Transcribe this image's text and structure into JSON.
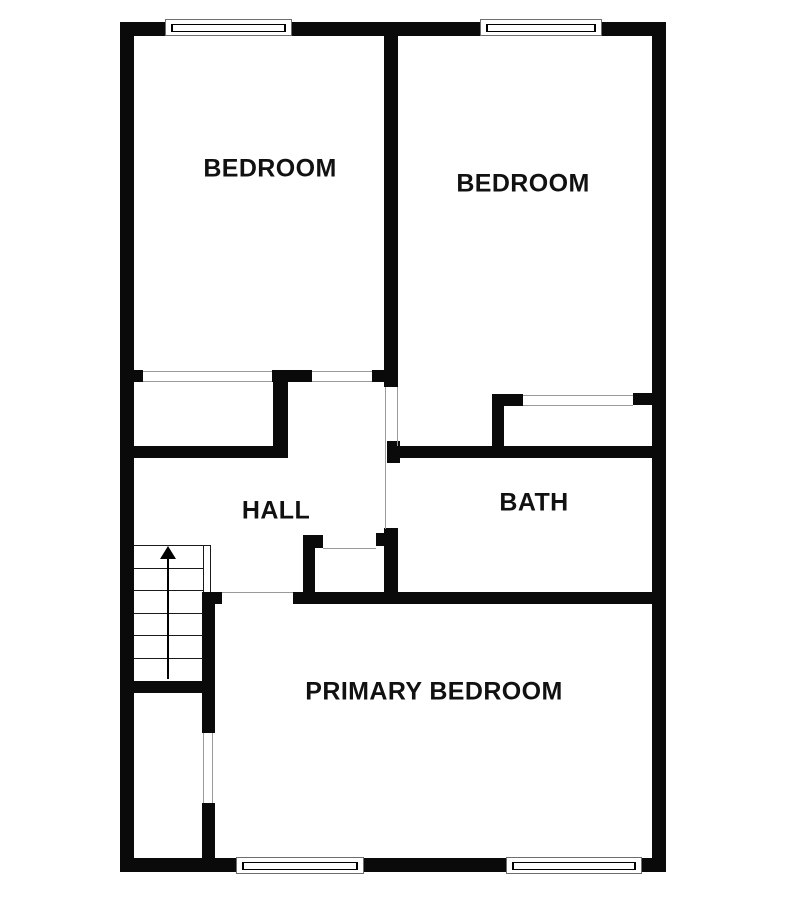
{
  "colors": {
    "wall": "#0a0a0a",
    "opening_line": "#9a9a9a",
    "stair_line": "#1a1a1a",
    "text": "#111111",
    "background": "#ffffff"
  },
  "rooms": [
    {
      "id": "bedroom-left",
      "label": "BEDROOM",
      "center": [
        270,
        169
      ]
    },
    {
      "id": "bedroom-right",
      "label": "BEDROOM",
      "center": [
        523,
        184
      ]
    },
    {
      "id": "hall",
      "label": "HALL",
      "center": [
        276,
        511
      ]
    },
    {
      "id": "bath",
      "label": "BATH",
      "center": [
        534,
        503
      ]
    },
    {
      "id": "primary-bedroom",
      "label": "PRIMARY BEDROOM",
      "center": [
        434,
        692
      ]
    }
  ],
  "walls": [
    {
      "name": "exterior-top",
      "x": 120,
      "y": 22,
      "w": 546,
      "h": 14
    },
    {
      "name": "exterior-left",
      "x": 120,
      "y": 22,
      "w": 14,
      "h": 850
    },
    {
      "name": "exterior-right",
      "x": 652,
      "y": 22,
      "w": 14,
      "h": 850
    },
    {
      "name": "exterior-bottom",
      "x": 120,
      "y": 858,
      "w": 546,
      "h": 14
    },
    {
      "name": "bedroom-divider",
      "x": 384,
      "y": 36,
      "w": 14,
      "h": 351
    },
    {
      "name": "bedroom1-south-stub-left",
      "x": 134,
      "y": 370,
      "w": 9,
      "h": 12
    },
    {
      "name": "bedroom1-south-mid",
      "x": 272,
      "y": 370,
      "w": 40,
      "h": 12
    },
    {
      "name": "bedroom1-south-stub-right",
      "x": 372,
      "y": 370,
      "w": 12,
      "h": 12
    },
    {
      "name": "bedroom1-closet-east",
      "x": 273,
      "y": 382,
      "w": 15,
      "h": 76
    },
    {
      "name": "hall-north",
      "x": 120,
      "y": 446,
      "w": 168,
      "h": 12
    },
    {
      "name": "bedroom2-south-left",
      "x": 492,
      "y": 394,
      "w": 31,
      "h": 12
    },
    {
      "name": "bedroom2-closet-west",
      "x": 492,
      "y": 394,
      "w": 12,
      "h": 64
    },
    {
      "name": "bedroom2-south-stub-right",
      "x": 633,
      "y": 393,
      "w": 19,
      "h": 12
    },
    {
      "name": "bath-north-stub",
      "x": 387,
      "y": 441,
      "w": 13,
      "h": 22
    },
    {
      "name": "bath-north",
      "x": 387,
      "y": 446,
      "w": 265,
      "h": 12
    },
    {
      "name": "hall-south",
      "x": 293,
      "y": 592,
      "w": 359,
      "h": 12
    },
    {
      "name": "hall-south-corner",
      "x": 202,
      "y": 592,
      "w": 20,
      "h": 12
    },
    {
      "name": "closet-east-upper",
      "x": 202,
      "y": 592,
      "w": 13,
      "h": 141
    },
    {
      "name": "closet-east-lower",
      "x": 202,
      "y": 803,
      "w": 13,
      "h": 55
    },
    {
      "name": "stairwell-south",
      "x": 134,
      "y": 681,
      "w": 81,
      "h": 12
    },
    {
      "name": "hall-closet-west",
      "x": 303,
      "y": 535,
      "w": 12,
      "h": 57
    },
    {
      "name": "hall-closet-west-jamb",
      "x": 315,
      "y": 535,
      "w": 8,
      "h": 13
    },
    {
      "name": "hall-closet-east",
      "x": 384,
      "y": 528,
      "w": 14,
      "h": 64
    },
    {
      "name": "hall-closet-east-jamb",
      "x": 376,
      "y": 533,
      "w": 8,
      "h": 13
    }
  ],
  "opening_lines": [
    {
      "name": "bedroom1-closet-opening-top",
      "x": 143,
      "y": 371,
      "w": 129,
      "h": 1.3
    },
    {
      "name": "bedroom1-closet-opening-bottom",
      "x": 143,
      "y": 380.7,
      "w": 129,
      "h": 1.3
    },
    {
      "name": "bedroom1-door-opening-top",
      "x": 312,
      "y": 371,
      "w": 60,
      "h": 1.3
    },
    {
      "name": "bedroom1-door-opening-bottom",
      "x": 312,
      "y": 380.7,
      "w": 60,
      "h": 1.3
    },
    {
      "name": "vestibule-opening-west",
      "x": 385,
      "y": 387,
      "w": 1.3,
      "h": 142
    },
    {
      "name": "vestibule-opening-east",
      "x": 396.7,
      "y": 387,
      "w": 1.3,
      "h": 59
    },
    {
      "name": "bedroom2-closet-opening-top",
      "x": 523,
      "y": 394.5,
      "w": 110,
      "h": 1.3
    },
    {
      "name": "bedroom2-closet-opening-bottom",
      "x": 523,
      "y": 404.7,
      "w": 110,
      "h": 1.3
    },
    {
      "name": "hall-closet-opening",
      "x": 323,
      "y": 548,
      "w": 53,
      "h": 1.3
    },
    {
      "name": "primary-bedroom-door-opening",
      "x": 222,
      "y": 592,
      "w": 71,
      "h": 1.3
    },
    {
      "name": "closet-door-opening-west",
      "x": 202.7,
      "y": 733,
      "w": 1.3,
      "h": 70
    },
    {
      "name": "closet-door-opening-east",
      "x": 212,
      "y": 733,
      "w": 1.3,
      "h": 70
    }
  ],
  "windows": [
    {
      "name": "window-top-left",
      "x": 165,
      "y": 19,
      "w": 127,
      "h": 17
    },
    {
      "name": "window-top-right",
      "x": 480,
      "y": 19,
      "w": 122,
      "h": 17
    },
    {
      "name": "window-bottom-left",
      "x": 236,
      "y": 857,
      "w": 128,
      "h": 17
    },
    {
      "name": "window-bottom-right",
      "x": 506,
      "y": 857,
      "w": 136,
      "h": 17
    }
  ],
  "stairs": {
    "x1": 134,
    "x2": 203,
    "top": 545,
    "bottom": 681,
    "tread_ys": [
      545,
      567.5,
      590,
      612.5,
      635,
      658
    ],
    "rail": {
      "x1": 202.7,
      "x2": 209.7,
      "top": 545,
      "bottom": 592
    },
    "arrow": {
      "x": 168,
      "tip_y": 546,
      "shaft_bottom": 679
    }
  }
}
